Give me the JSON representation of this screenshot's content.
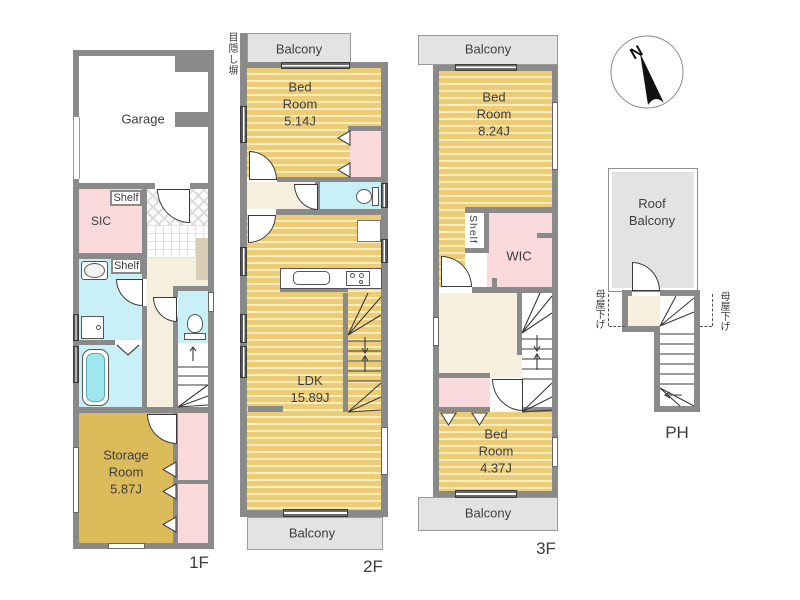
{
  "colors": {
    "wall": "#8A8A8A",
    "floor_stripe_gold": "#ECCC74",
    "floor_stripe_light": "#F8EBBE",
    "storage_gold": "#DCBB5B",
    "closet_pink": "#FAD9DD",
    "wet_area_cyan": "#C9F0F6",
    "hall_beige": "#F6EFDE",
    "balcony_gray": "#E3E3E3",
    "line": "#3A3A3A"
  },
  "compass": {
    "north_label": "N"
  },
  "floor_1": {
    "floor_label": "1F",
    "garage_label": "Garage",
    "sic_label": "SIC",
    "shelf_upper_label": "Shelf",
    "shelf_lower_label": "Shelf",
    "storage_room_label": "Storage\nRoom\n5.87J"
  },
  "floor_2": {
    "floor_label": "2F",
    "balcony_top_label": "Balcony",
    "balcony_bottom_label": "Balcony",
    "privacy_screen_label": "目隠し塀",
    "bedroom_label": "Bed\nRoom\n5.14J",
    "ldk_label": "LDK\n15.89J"
  },
  "floor_3": {
    "floor_label": "3F",
    "balcony_top_label": "Balcony",
    "balcony_bottom_label": "Balcony",
    "bedroom_large_label": "Bed\nRoom\n8.24J",
    "shelf_label": "Shelf",
    "wic_label": "WIC",
    "bedroom_small_label": "Bed\nRoom\n4.37J"
  },
  "penthouse": {
    "floor_label": "PH",
    "roof_balcony_label": "Roof\nBalcony",
    "roof_lowering_left_label": "母屋下げ",
    "roof_lowering_right_label": "母屋下げ"
  }
}
